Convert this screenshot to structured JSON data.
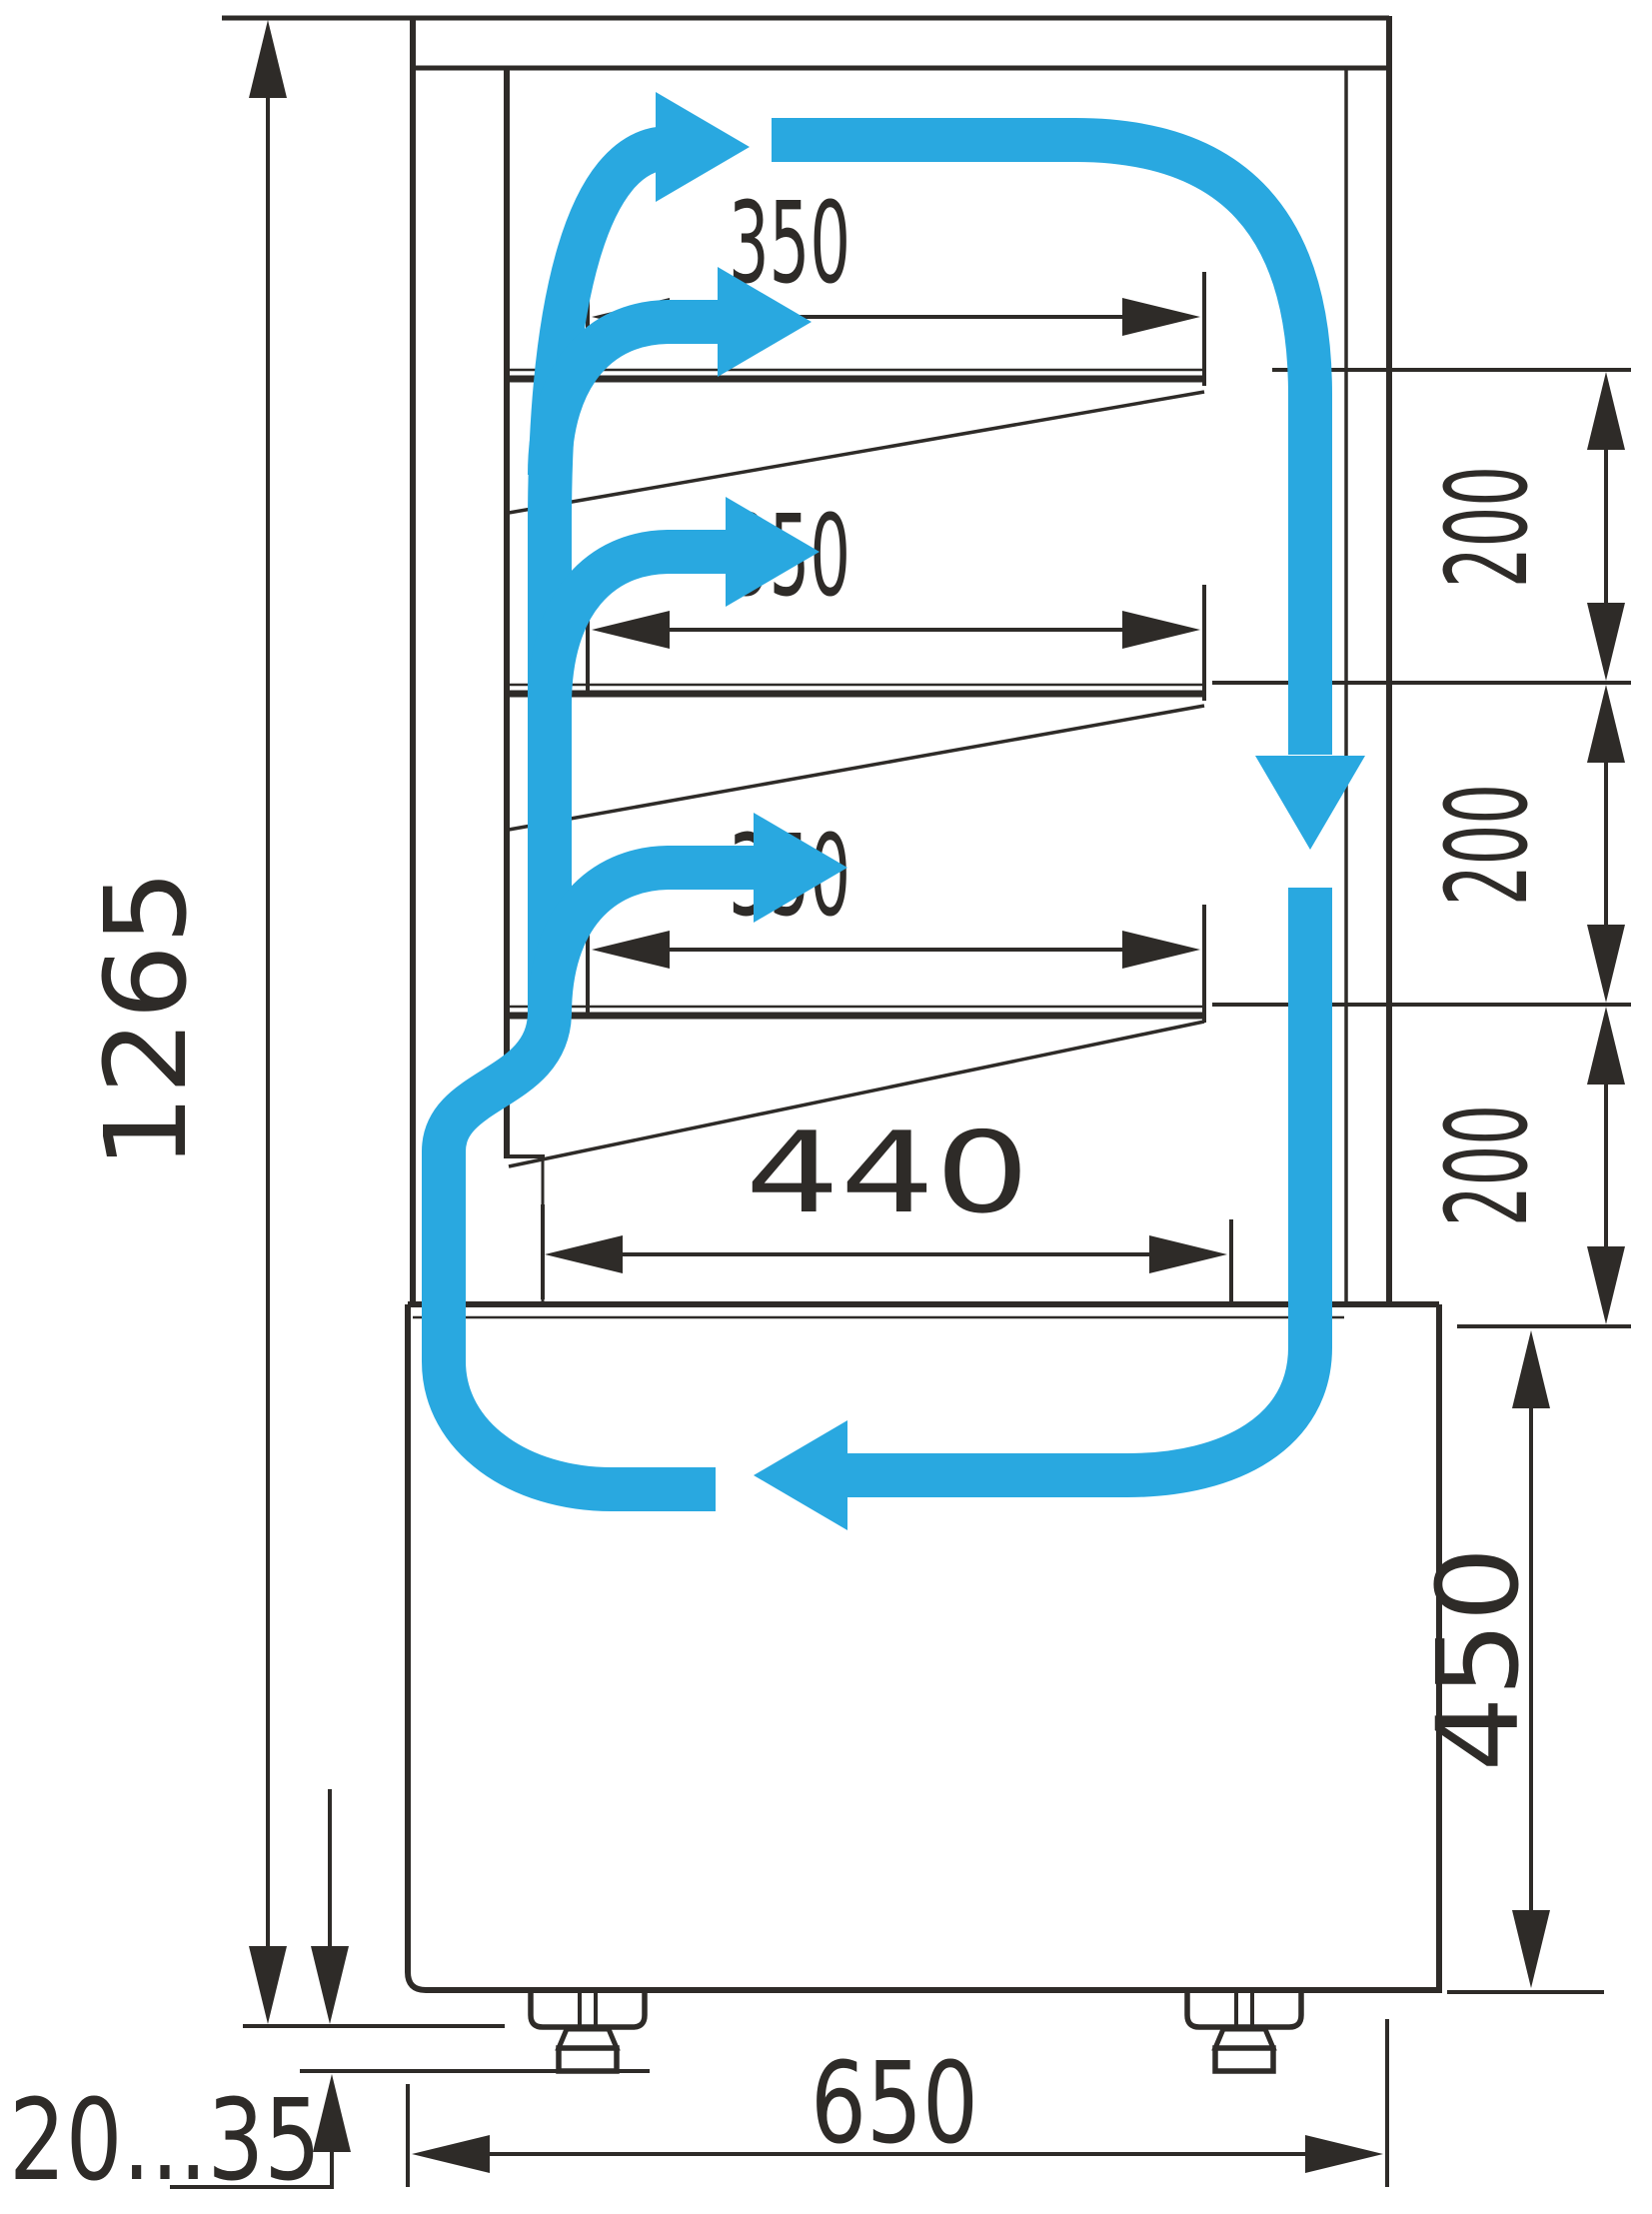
{
  "colors": {
    "ink": "#2e2b28",
    "flow_blue": "#29a8e0",
    "background": "#ffffff"
  },
  "dims": {
    "overall_height": "1265",
    "shelf_depths": [
      "350",
      "350",
      "350"
    ],
    "shelf_spacings": [
      "200",
      "200",
      "200"
    ],
    "bottom_shelf_depth": "440",
    "base_height": "450",
    "overall_depth": "650",
    "leg_adjustment": "20...35"
  }
}
